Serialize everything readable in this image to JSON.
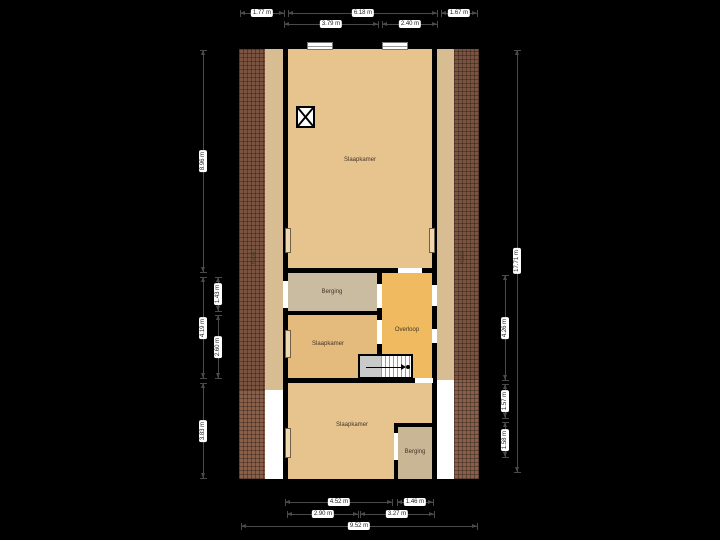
{
  "plan": {
    "canvas": {
      "width": 720,
      "height": 540,
      "background": "#000000"
    },
    "colors": {
      "wall": "#000000",
      "brick_upper": "#7a5440",
      "brick_lower": "#8a5e48",
      "tan_strip": "#d8bc92",
      "void_white": "#ffffff",
      "bedroom": "#e7c38e",
      "bedroom_small": "#e4ba7d",
      "storage": "#cabca0",
      "storage_bottom": "#c9b694",
      "landing": "#f0ba60",
      "measure_line": "#4a4a4a",
      "measure_chip_bg": "#ffffff",
      "measure_chip_text": "#1c1c1c"
    },
    "shell": {
      "x": 235,
      "y": 44,
      "w": 249,
      "h": 440
    },
    "regions": [
      {
        "name": "left-roof-strip-upper",
        "x": 239,
        "y": 49,
        "w": 26,
        "h": 341,
        "fill": "brick_upper",
        "pattern": "brick"
      },
      {
        "name": "left-roof-strip-lower",
        "x": 239,
        "y": 390,
        "w": 26,
        "h": 89,
        "fill": "brick_lower",
        "pattern": "brick lower"
      },
      {
        "name": "right-roof-strip-upper",
        "x": 454,
        "y": 49,
        "w": 25,
        "h": 331,
        "fill": "brick_upper",
        "pattern": "brick"
      },
      {
        "name": "right-roof-strip-lower",
        "x": 454,
        "y": 380,
        "w": 25,
        "h": 99,
        "fill": "brick_lower",
        "pattern": "brick lower"
      },
      {
        "name": "left-eaves-strip",
        "x": 265,
        "y": 49,
        "w": 18,
        "h": 341,
        "fill": "tan_strip"
      },
      {
        "name": "right-eaves-strip",
        "x": 437,
        "y": 49,
        "w": 17,
        "h": 331,
        "fill": "tan_strip"
      },
      {
        "name": "left-void",
        "x": 265,
        "y": 390,
        "w": 18,
        "h": 89,
        "fill": "void_white"
      },
      {
        "name": "right-void",
        "x": 437,
        "y": 380,
        "w": 17,
        "h": 99,
        "fill": "void_white"
      },
      {
        "name": "room-slaapkamer-large",
        "x": 288,
        "y": 49,
        "w": 144,
        "h": 219,
        "fill": "bedroom"
      },
      {
        "name": "room-berging-top",
        "x": 288,
        "y": 273,
        "w": 89,
        "h": 38,
        "fill": "storage"
      },
      {
        "name": "room-slaapkamer-small",
        "x": 288,
        "y": 315,
        "w": 89,
        "h": 63,
        "fill": "bedroom_small"
      },
      {
        "name": "room-overloop",
        "x": 382,
        "y": 273,
        "w": 50,
        "h": 105,
        "fill": "landing"
      },
      {
        "name": "room-slaapkamer-bottom",
        "x": 288,
        "y": 383,
        "w": 144,
        "h": 96,
        "fill": "bedroom"
      },
      {
        "name": "room-berging-bottom",
        "x": 398,
        "y": 427,
        "w": 34,
        "h": 52,
        "fill": "storage_bottom"
      }
    ],
    "walls": [
      {
        "x": 283,
        "y": 49,
        "w": 5,
        "h": 224
      },
      {
        "x": 432,
        "y": 49,
        "w": 5,
        "h": 224
      },
      {
        "x": 283,
        "y": 268,
        "w": 154,
        "h": 5
      },
      {
        "x": 377,
        "y": 273,
        "w": 5,
        "h": 81
      },
      {
        "x": 283,
        "y": 311,
        "w": 99,
        "h": 4
      },
      {
        "x": 283,
        "y": 378,
        "w": 154,
        "h": 5
      },
      {
        "x": 394,
        "y": 423,
        "w": 38,
        "h": 4
      },
      {
        "x": 394,
        "y": 427,
        "w": 4,
        "h": 52
      }
    ],
    "openings": [
      {
        "name": "door-slaapkamer-overloop",
        "x": 398,
        "y": 268,
        "w": 24,
        "h": 5
      },
      {
        "name": "door-berging-top-left",
        "x": 283,
        "y": 281,
        "w": 5,
        "h": 27
      },
      {
        "name": "door-berging-overloop",
        "x": 377,
        "y": 284,
        "w": 5,
        "h": 24
      },
      {
        "name": "door-overloop-right-upper",
        "x": 432,
        "y": 285,
        "w": 5,
        "h": 21
      },
      {
        "name": "door-overloop-right-lower",
        "x": 432,
        "y": 329,
        "w": 5,
        "h": 14
      },
      {
        "name": "door-slaapkamer-small",
        "x": 377,
        "y": 320,
        "w": 5,
        "h": 24
      },
      {
        "name": "door-overloop-bottom",
        "x": 415,
        "y": 378,
        "w": 18,
        "h": 5
      },
      {
        "name": "door-berging-bottom",
        "x": 394,
        "y": 433,
        "w": 4,
        "h": 27
      }
    ],
    "windows": [
      {
        "name": "window-top-left",
        "x": 307,
        "y": 42,
        "w": 26,
        "h": 8
      },
      {
        "name": "window-top-right",
        "x": 382,
        "y": 42,
        "w": 26,
        "h": 8
      }
    ],
    "fixtures": {
      "roof_window": {
        "x": 296,
        "y": 106,
        "w": 19,
        "h": 22
      },
      "radiators": [
        {
          "x": 285,
          "y": 228,
          "w": 6,
          "h": 25
        },
        {
          "x": 429,
          "y": 228,
          "w": 6,
          "h": 25
        },
        {
          "x": 285,
          "y": 330,
          "w": 6,
          "h": 28
        },
        {
          "x": 285,
          "y": 428,
          "w": 6,
          "h": 30
        }
      ],
      "stairs": {
        "x": 358,
        "y": 354,
        "w": 55,
        "h": 25
      }
    },
    "room_labels": [
      {
        "text": "Slaapkamer",
        "x": 360,
        "y": 160,
        "rotate": false
      },
      {
        "text": "Berging",
        "x": 332,
        "y": 292,
        "rotate": false
      },
      {
        "text": "Slaapkamer",
        "x": 328,
        "y": 344,
        "rotate": false
      },
      {
        "text": "Overloop",
        "x": 407,
        "y": 330,
        "rotate": false
      },
      {
        "text": "Slaapkamer",
        "x": 352,
        "y": 425,
        "rotate": false
      },
      {
        "text": "Berging",
        "x": 415,
        "y": 452,
        "rotate": false
      },
      {
        "text": "Kast",
        "x": 254,
        "y": 258,
        "rotate": true
      },
      {
        "text": "Kast",
        "x": 463,
        "y": 258,
        "rotate": true
      }
    ],
    "measurements": {
      "horizontal": [
        {
          "y": 13,
          "segments": [
            {
              "x1": 240,
              "x2": 284,
              "label": "1.77 m"
            },
            {
              "x1": 288,
              "x2": 437,
              "label": "6.18 m"
            },
            {
              "x1": 441,
              "x2": 477,
              "label": "1.67 m"
            }
          ]
        },
        {
          "y": 24,
          "segments": [
            {
              "x1": 284,
              "x2": 378,
              "label": "3.79 m"
            },
            {
              "x1": 382,
              "x2": 437,
              "label": "2.40 m"
            }
          ]
        },
        {
          "y": 502,
          "segments": [
            {
              "x1": 285,
              "x2": 392,
              "label": "4.52 m"
            },
            {
              "x1": 397,
              "x2": 433,
              "label": "1.46 m"
            }
          ]
        },
        {
          "y": 514,
          "segments": [
            {
              "x1": 287,
              "x2": 358,
              "label": "2.90 m"
            },
            {
              "x1": 360,
              "x2": 434,
              "label": "3.27 m"
            }
          ]
        },
        {
          "y": 526,
          "segments": [
            {
              "x1": 241,
              "x2": 477,
              "label": "9.52 m"
            }
          ]
        }
      ],
      "vertical": [
        {
          "x": 203,
          "segments": [
            {
              "y1": 50,
              "y2": 272,
              "label": "8.96 m"
            },
            {
              "y1": 277,
              "y2": 378,
              "label": "4.19 m"
            },
            {
              "y1": 383,
              "y2": 478,
              "label": "3.83 m"
            }
          ]
        },
        {
          "x": 218,
          "segments": [
            {
              "y1": 277,
              "y2": 311,
              "label": "1.43 m"
            },
            {
              "y1": 315,
              "y2": 378,
              "label": "2.60 m"
            }
          ]
        },
        {
          "x": 505,
          "segments": [
            {
              "y1": 275,
              "y2": 380,
              "label": "4.26 m"
            },
            {
              "y1": 384,
              "y2": 418,
              "label": "1.57 m"
            },
            {
              "y1": 422,
              "y2": 457,
              "label": "1.58 m"
            }
          ]
        },
        {
          "x": 517,
          "segments": [
            {
              "y1": 50,
              "y2": 472,
              "label": "17.71 m"
            }
          ]
        }
      ]
    }
  }
}
